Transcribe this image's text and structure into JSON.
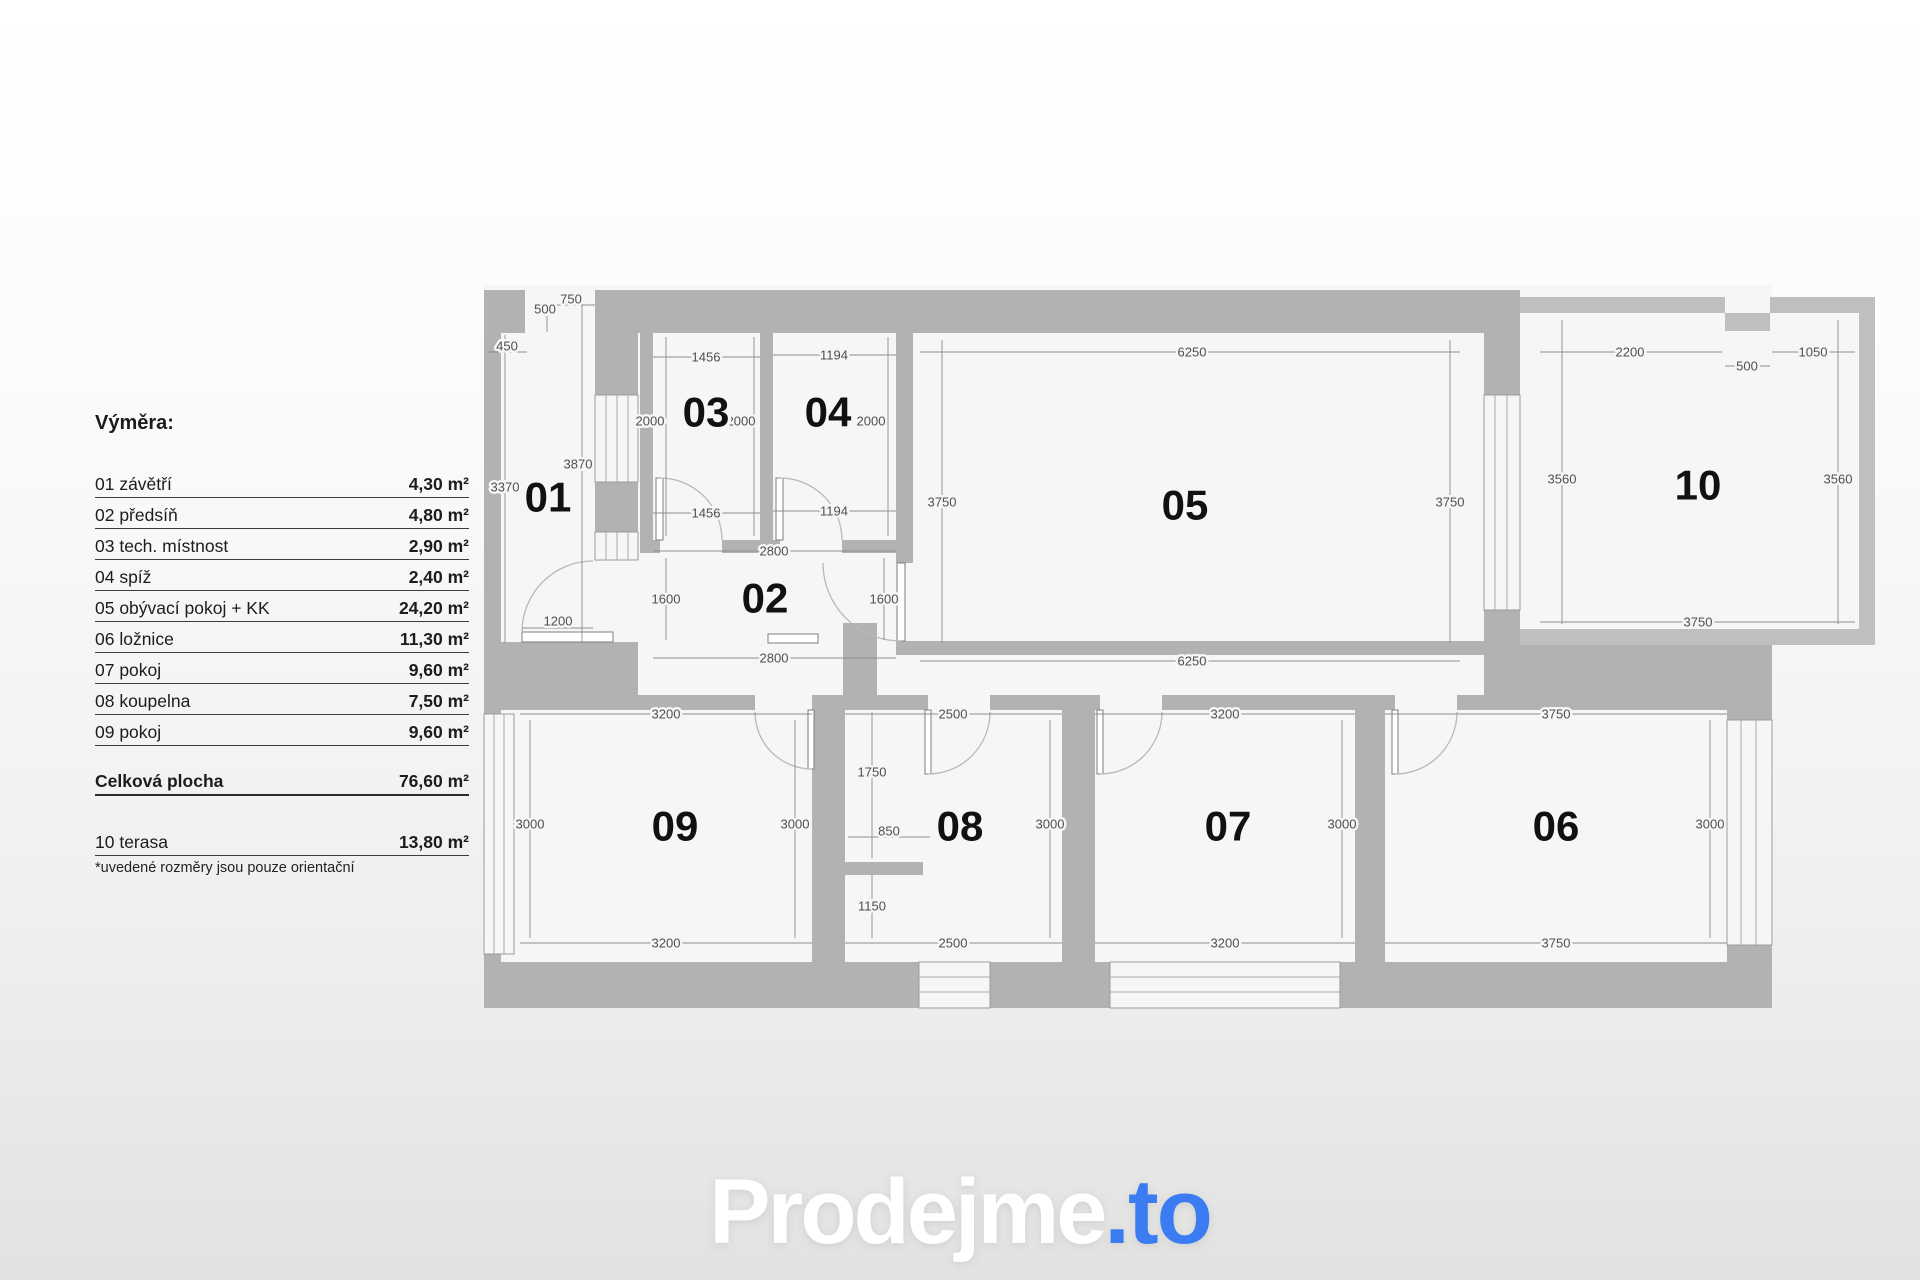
{
  "legend": {
    "title": "Výměra:",
    "items": [
      {
        "label": "01 závětří",
        "area": "4,30 m²"
      },
      {
        "label": "02 předsíň",
        "area": "4,80 m²"
      },
      {
        "label": "03 tech. místnost",
        "area": "2,90 m²"
      },
      {
        "label": "04 spíž",
        "area": "2,40 m²"
      },
      {
        "label": "05 obývací pokoj + KK",
        "area": "24,20 m²"
      },
      {
        "label": "06 ložnice",
        "area": "11,30 m²"
      },
      {
        "label": "07 pokoj",
        "area": "9,60 m²"
      },
      {
        "label": "08 koupelna",
        "area": "7,50 m²"
      },
      {
        "label": "09 pokoj",
        "area": "9,60 m²"
      }
    ],
    "total": {
      "label": "Celková plocha",
      "area": "76,60 m²"
    },
    "extra": {
      "label": "10 terasa",
      "area": "13,80 m²"
    },
    "footnote": "*uvedené rozměry jsou pouze orientační"
  },
  "logo": {
    "main": "Prodejme",
    "suffix": ".to"
  },
  "colors": {
    "wall": "#b2b2b2",
    "room": "#f6f6f7",
    "dim_text": "#4f4f4f",
    "accent_blue": "#3b7cf2"
  },
  "plan": {
    "rooms": [
      {
        "n": "01",
        "x": 548,
        "y": 497
      },
      {
        "n": "02",
        "x": 765,
        "y": 598
      },
      {
        "n": "03",
        "x": 706,
        "y": 412
      },
      {
        "n": "04",
        "x": 828,
        "y": 412
      },
      {
        "n": "05",
        "x": 1185,
        "y": 505
      },
      {
        "n": "06",
        "x": 1556,
        "y": 826
      },
      {
        "n": "07",
        "x": 1228,
        "y": 826
      },
      {
        "n": "08",
        "x": 960,
        "y": 826
      },
      {
        "n": "09",
        "x": 675,
        "y": 826
      },
      {
        "n": "10",
        "x": 1698,
        "y": 485
      }
    ],
    "dims": [
      {
        "t": "500",
        "x": 545,
        "y": 309,
        "l": [
          547,
          316,
          547,
          332
        ]
      },
      {
        "t": "750",
        "x": 571,
        "y": 299,
        "l": [
          547,
          305,
          595,
          305
        ]
      },
      {
        "t": "450",
        "x": 507,
        "y": 346,
        "l": [
          487,
          352,
          527,
          352
        ]
      },
      {
        "t": "3370",
        "x": 505,
        "y": 487,
        "l": [
          505,
          335,
          505,
          643
        ]
      },
      {
        "t": "3870",
        "x": 578,
        "y": 464,
        "l": [
          582,
          295,
          582,
          643
        ]
      },
      {
        "t": "1456",
        "x": 706,
        "y": 357,
        "l": [
          653,
          357,
          760,
          357
        ]
      },
      {
        "t": "1194",
        "x": 834,
        "y": 355,
        "l": [
          773,
          355,
          896,
          355
        ]
      },
      {
        "t": "2000",
        "x": 650,
        "y": 421,
        "l": [
          666,
          337,
          666,
          536
        ]
      },
      {
        "t": "2000",
        "x": 741,
        "y": 421,
        "l": [
          754,
          337,
          754,
          536
        ]
      },
      {
        "t": "2000",
        "x": 871,
        "y": 421,
        "l": [
          888,
          337,
          888,
          536
        ]
      },
      {
        "t": "1456",
        "x": 706,
        "y": 513,
        "l": [
          653,
          513,
          760,
          513
        ]
      },
      {
        "t": "1194",
        "x": 834,
        "y": 511,
        "l": [
          773,
          511,
          896,
          511
        ]
      },
      {
        "t": "2800",
        "x": 774,
        "y": 551,
        "l": [
          653,
          551,
          896,
          551
        ]
      },
      {
        "t": "1600",
        "x": 666,
        "y": 599,
        "l": [
          666,
          558,
          666,
          640
        ]
      },
      {
        "t": "1600",
        "x": 884,
        "y": 599,
        "l": [
          884,
          558,
          884,
          640
        ]
      },
      {
        "t": "2800",
        "x": 774,
        "y": 658,
        "l": [
          653,
          658,
          896,
          658
        ]
      },
      {
        "t": "1200",
        "x": 558,
        "y": 621,
        "l": [
          522,
          628,
          593,
          628
        ]
      },
      {
        "t": "6250",
        "x": 1192,
        "y": 352,
        "l": [
          920,
          352,
          1460,
          352
        ]
      },
      {
        "t": "6250",
        "x": 1192,
        "y": 661,
        "l": [
          920,
          661,
          1460,
          661
        ]
      },
      {
        "t": "3750",
        "x": 942,
        "y": 502,
        "l": [
          942,
          340,
          942,
          643
        ]
      },
      {
        "t": "3750",
        "x": 1450,
        "y": 502,
        "l": [
          1450,
          340,
          1450,
          643
        ]
      },
      {
        "t": "2200",
        "x": 1630,
        "y": 352,
        "l": [
          1540,
          352,
          1722,
          352
        ]
      },
      {
        "t": "500",
        "x": 1747,
        "y": 366,
        "l": [
          1725,
          366,
          1770,
          366
        ]
      },
      {
        "t": "1050",
        "x": 1813,
        "y": 352,
        "l": [
          1772,
          352,
          1855,
          352
        ]
      },
      {
        "t": "3560",
        "x": 1562,
        "y": 479,
        "l": [
          1562,
          320,
          1562,
          624
        ]
      },
      {
        "t": "3560",
        "x": 1838,
        "y": 479,
        "l": [
          1838,
          320,
          1838,
          624
        ]
      },
      {
        "t": "3750",
        "x": 1698,
        "y": 622,
        "l": [
          1540,
          622,
          1855,
          622
        ]
      },
      {
        "t": "3200",
        "x": 666,
        "y": 714,
        "l": [
          520,
          714,
          812,
          714
        ]
      },
      {
        "t": "3200",
        "x": 666,
        "y": 943,
        "l": [
          520,
          943,
          812,
          943
        ]
      },
      {
        "t": "2500",
        "x": 953,
        "y": 714,
        "l": [
          845,
          714,
          1062,
          714
        ]
      },
      {
        "t": "2500",
        "x": 953,
        "y": 943,
        "l": [
          845,
          943,
          1062,
          943
        ]
      },
      {
        "t": "3200",
        "x": 1225,
        "y": 714,
        "l": [
          1095,
          714,
          1355,
          714
        ]
      },
      {
        "t": "3200",
        "x": 1225,
        "y": 943,
        "l": [
          1095,
          943,
          1355,
          943
        ]
      },
      {
        "t": "3750",
        "x": 1556,
        "y": 714,
        "l": [
          1385,
          714,
          1727,
          714
        ]
      },
      {
        "t": "3750",
        "x": 1556,
        "y": 943,
        "l": [
          1385,
          943,
          1727,
          943
        ]
      },
      {
        "t": "3000",
        "x": 530,
        "y": 824,
        "l": [
          530,
          720,
          530,
          938
        ]
      },
      {
        "t": "3000",
        "x": 795,
        "y": 824,
        "l": [
          795,
          720,
          795,
          938
        ]
      },
      {
        "t": "3000",
        "x": 1050,
        "y": 824,
        "l": [
          1050,
          720,
          1050,
          938
        ]
      },
      {
        "t": "3000",
        "x": 1342,
        "y": 824,
        "l": [
          1342,
          720,
          1342,
          938
        ]
      },
      {
        "t": "3000",
        "x": 1710,
        "y": 824,
        "l": [
          1710,
          720,
          1710,
          938
        ]
      },
      {
        "t": "1750",
        "x": 872,
        "y": 772,
        "l": [
          872,
          712,
          872,
          858
        ]
      },
      {
        "t": "850",
        "x": 889,
        "y": 831,
        "l": [
          848,
          837,
          930,
          837
        ]
      },
      {
        "t": "1150",
        "x": 872,
        "y": 906,
        "l": [
          872,
          875,
          872,
          938
        ]
      }
    ]
  }
}
